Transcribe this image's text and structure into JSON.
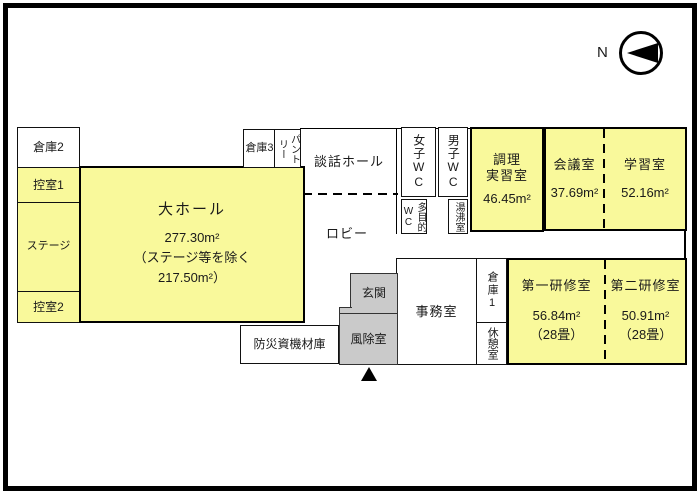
{
  "compass": {
    "label": "N"
  },
  "colors": {
    "room_fill_yellow": "#f9f99b",
    "entrance_fill_gray": "#cacaca",
    "line_black": "#000000"
  },
  "rooms": {
    "storage2": {
      "label": "倉庫2"
    },
    "waiting1": {
      "label": "控室1"
    },
    "stage": {
      "label": "ステージ"
    },
    "waiting2": {
      "label": "控室2"
    },
    "main_hall": {
      "label": "大ホール",
      "area": "277.30m²",
      "area_note_1": "（ステージ等を除く",
      "area_note_2": "217.50m²）"
    },
    "storage3": {
      "label": "倉庫3"
    },
    "pantry": {
      "label": "パントリー"
    },
    "lounge_hall": {
      "label": "談話ホール"
    },
    "lobby": {
      "label": "ロビー"
    },
    "womens_wc": {
      "label": "女子WC"
    },
    "mens_wc": {
      "label": "男子WC"
    },
    "multipurpose_wc": {
      "label": "多目的WC"
    },
    "hot_water_room": {
      "label": "湯沸室"
    },
    "cooking_room": {
      "label_line1": "調理",
      "label_line2": "実習室",
      "area": "46.45m²"
    },
    "meeting_room": {
      "label": "会議室",
      "area": "37.69m²"
    },
    "study_room": {
      "label": "学習室",
      "area": "52.16m²"
    },
    "entrance_hall": {
      "label": "玄関"
    },
    "windbreak_room": {
      "label": "風除室"
    },
    "office": {
      "label": "事務室"
    },
    "storage1": {
      "label": "倉庫1"
    },
    "rest_room": {
      "label": "休憩室"
    },
    "training_room1": {
      "label": "第一研修室",
      "area": "56.84m²",
      "tatami": "（28畳）"
    },
    "training_room2": {
      "label": "第二研修室",
      "area": "50.91m²",
      "tatami": "（28畳）"
    },
    "disaster_storage": {
      "label": "防災資機材庫"
    }
  }
}
